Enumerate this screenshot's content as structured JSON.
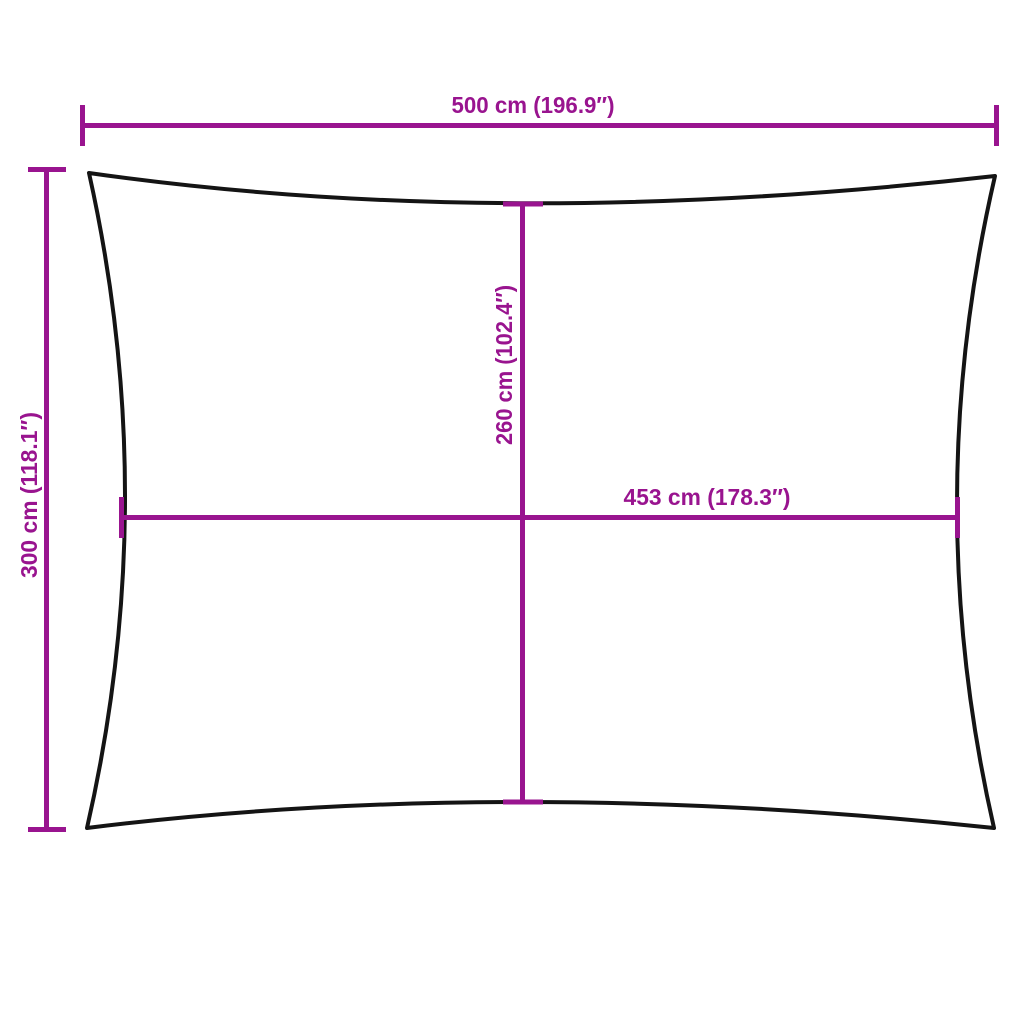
{
  "diagram": {
    "kind": "product-dimension-diagram",
    "shape": "rectangle-with-concave-edges"
  },
  "colors": {
    "dimension": "#99148F",
    "outline": "#141414",
    "background": "#FFFFFF"
  },
  "dimensions": {
    "overall_width": {
      "label": "500 cm (196.9″)",
      "cm": 500,
      "inches": 196.9
    },
    "overall_height": {
      "label": "300 cm (118.1″)",
      "cm": 300,
      "inches": 118.1
    },
    "center_height": {
      "label": "260 cm (102.4″)",
      "cm": 260,
      "inches": 102.4
    },
    "center_width": {
      "label": "453 cm (178.3″)",
      "cm": 453,
      "inches": 178.3
    }
  }
}
